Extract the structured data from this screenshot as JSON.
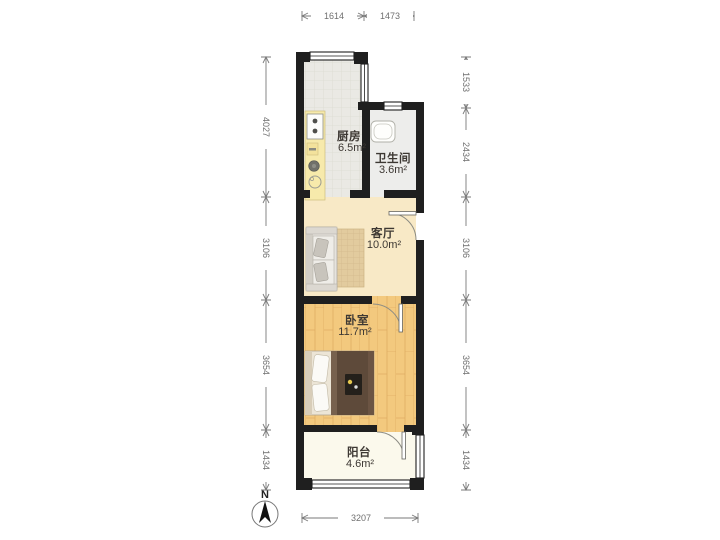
{
  "floorplan": {
    "compass": {
      "north_label": "N"
    },
    "rooms": [
      {
        "name": "厨房",
        "area": "6.5m²"
      },
      {
        "name": "卫生间",
        "area": "3.6m²"
      },
      {
        "name": "客厅",
        "area": "10.0m²"
      },
      {
        "name": "卧室",
        "area": "11.7m²"
      },
      {
        "name": "阳台",
        "area": "4.6m²"
      }
    ],
    "dimensions_mm": {
      "top": [
        "1614",
        "1473"
      ],
      "left": [
        "4027",
        "3106",
        "3654",
        "1434"
      ],
      "right": [
        "1533",
        "2434",
        "3106",
        "3654",
        "1434"
      ],
      "bottom": [
        "3207"
      ]
    },
    "colors": {
      "wall": "#1f1f1f",
      "kitchen_floor": "#eae9e4",
      "bathroom_floor": "#ededeb",
      "living_floor": "#f8e9c6",
      "bedroom_floor": "#f3c97e",
      "balcony_floor": "#fbf9ec",
      "counter": "#f7eaab",
      "dimension_line": "#7a7a7a"
    }
  }
}
